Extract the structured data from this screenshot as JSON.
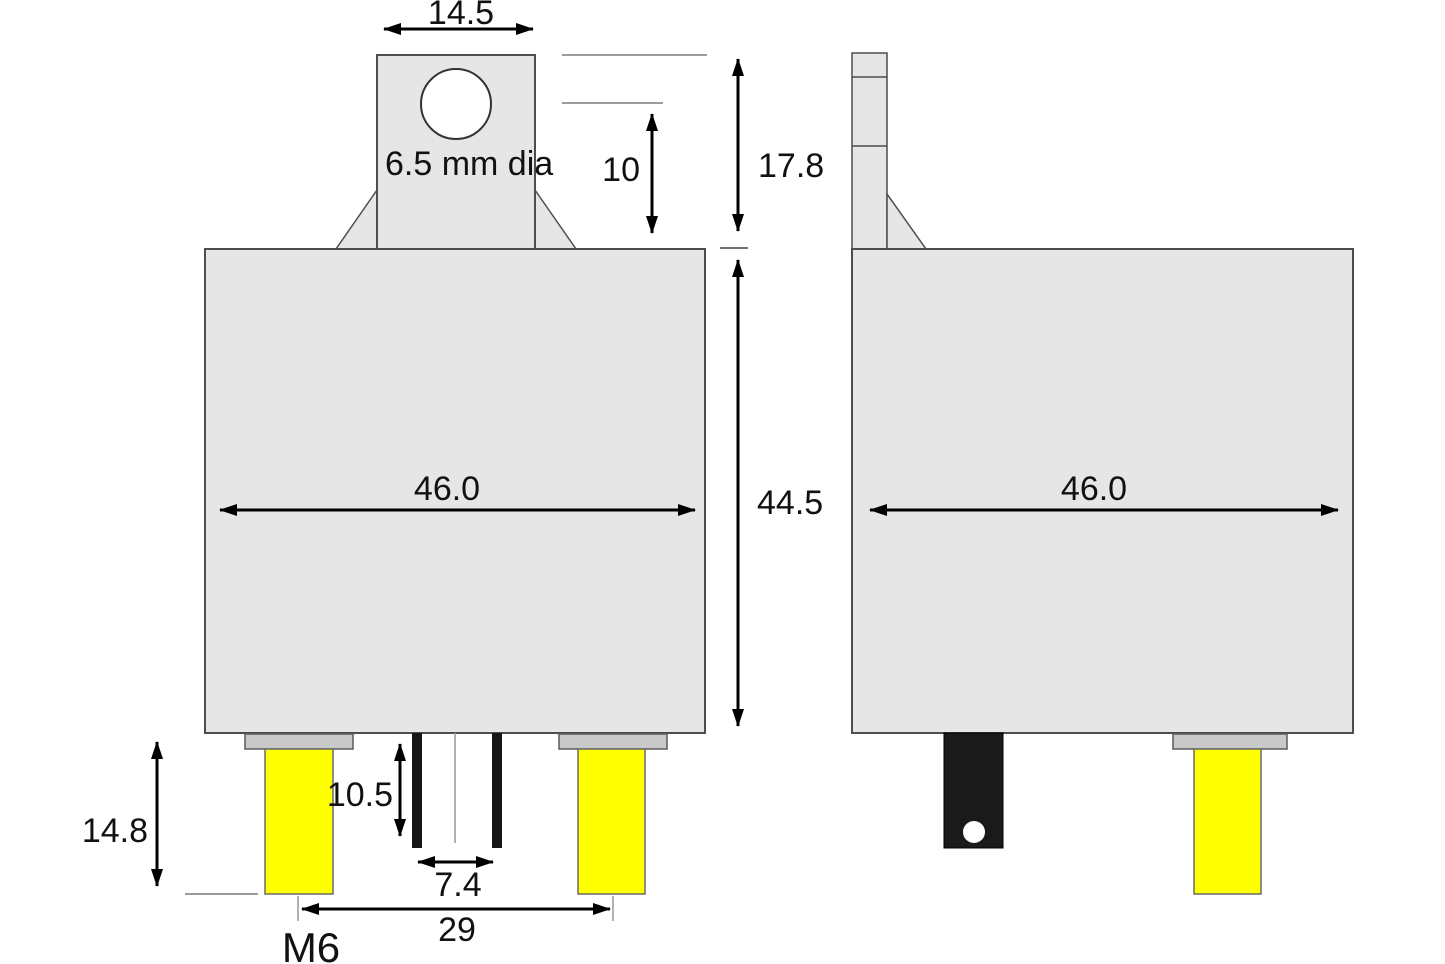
{
  "title": "Relay dimensional drawing, front and side views",
  "colors": {
    "body_fill": "#e6e6e6",
    "body_stroke": "#4d4d4d",
    "cap_fill": "#c9c9c9",
    "terminal_yellow": "#ffff00",
    "terminal_black": "#1a1a1a",
    "dim_line": "#000000",
    "ext_line": "#7a7a7a",
    "text_color": "#111111"
  },
  "dimensions": {
    "bracket_width": "14.5",
    "hole_label": "6.5 mm dia",
    "hole_to_body": "10",
    "bracket_height": "17.8",
    "front_body_width": "46.0",
    "body_height": "44.5",
    "side_body_width": "46.0",
    "pin_length": "10.5",
    "pin_pitch": "7.4",
    "stud_length": "14.8",
    "stud_pitch": "29",
    "stud_thread": "M6"
  }
}
